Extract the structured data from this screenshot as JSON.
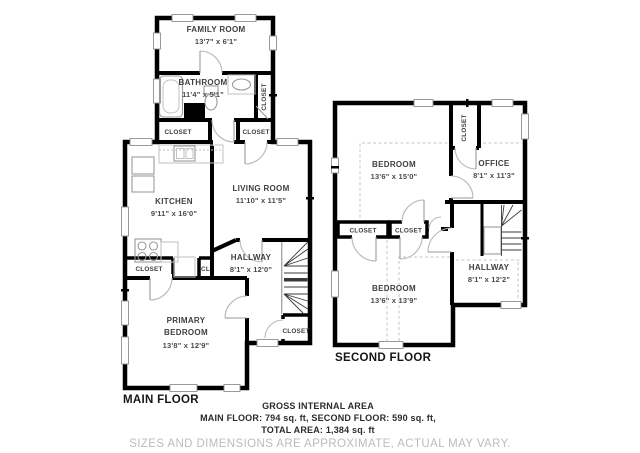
{
  "labels": {
    "closet": "CLOSET",
    "cl": "CL"
  },
  "main_floor": {
    "label": "MAIN FLOOR",
    "rooms": {
      "family_room": {
        "name": "FAMILY ROOM",
        "dims": "13'7\" x 6'1\""
      },
      "bathroom": {
        "name": "BATHROOM",
        "dims": "11'4\" x 5'1\""
      },
      "kitchen": {
        "name": "KITCHEN",
        "dims": "9'11\" x 16'0\""
      },
      "living_room": {
        "name": "LIVING ROOM",
        "dims": "11'10\" x 11'5\""
      },
      "hallway": {
        "name": "HALLWAY",
        "dims": "8'1\" x 12'0\""
      },
      "primary_bedroom": {
        "name1": "PRIMARY",
        "name2": "BEDROOM",
        "dims": "13'8\" x 12'9\""
      }
    }
  },
  "second_floor": {
    "label": "SECOND FLOOR",
    "rooms": {
      "bedroom1": {
        "name": "BEDROOM",
        "dims": "13'6\" x 15'0\""
      },
      "office": {
        "name": "OFFICE",
        "dims": "8'1\" x 11'3\""
      },
      "bedroom2": {
        "name": "BEDROOM",
        "dims": "13'6\" x 13'9\""
      },
      "hallway": {
        "name": "HALLWAY",
        "dims": "8'1\" x 12'2\""
      }
    }
  },
  "footer": {
    "title": "GROSS INTERNAL AREA",
    "floors": "MAIN FLOOR: 794 sq. ft, SECOND FLOOR: 590 sq. ft,",
    "total": "TOTAL AREA: 1,384 sq. ft",
    "disclaimer": "SIZES AND DIMENSIONS ARE APPROXIMATE, ACTUAL MAY VARY."
  }
}
